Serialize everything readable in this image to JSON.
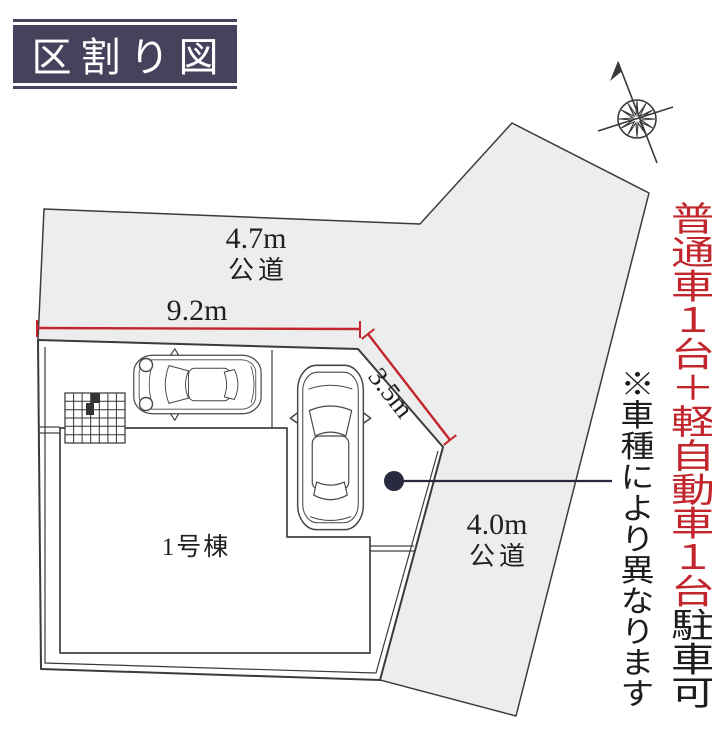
{
  "title": {
    "text": "区割り図"
  },
  "road_top": {
    "width_label": "4.7m",
    "type_label": "公道"
  },
  "road_right": {
    "width_label": "4.0m",
    "type_label": "公道"
  },
  "dimensions": {
    "frontage": "9.2m",
    "side_diagonal": "3.5m"
  },
  "building": {
    "label": "1号棟"
  },
  "parking_note": {
    "highlight": "普通車１台＋軽自動車１台",
    "suffix": "駐車可",
    "disclaimer": "※車種により異なります"
  },
  "icons": {
    "compass": "compass-north-icon",
    "leader_dot": "leader-dot",
    "cars": [
      "kei-car-top-view",
      "regular-car-top-view"
    ]
  },
  "colors": {
    "title_background": "#46425c",
    "road_fill": "#ededed",
    "outline": "#3b3b3b",
    "dimension_red": "#c2252b",
    "leader_navy": "#29293f"
  }
}
